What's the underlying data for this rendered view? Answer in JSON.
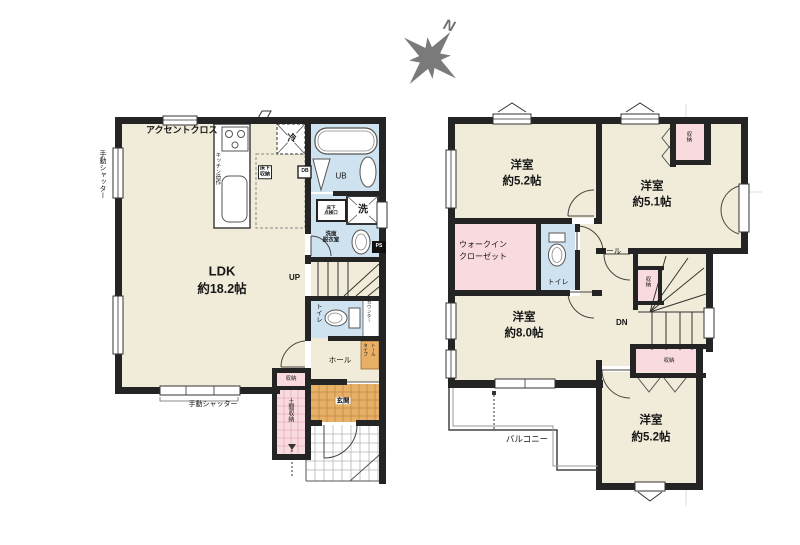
{
  "compass": {
    "north": "N"
  },
  "colors": {
    "wall": "#242424",
    "floor_cream": "#f1ecd9",
    "wet_blue": "#cfe2ef",
    "storage_pink": "#f9dbdf",
    "entrance_orange": "#e7b066",
    "compass_gray": "#7a7a7a"
  },
  "floor1": {
    "shutter_left": "手動シャッター",
    "accent_cross": "アクセントクロス",
    "kitchen": "キッチン造作",
    "fridge": "冷",
    "underfloor_storage": "床下\n収納",
    "db": "DB",
    "unit_bath": "UB",
    "inspection_hatch": "床下\n点検口",
    "laundry": "洗",
    "washroom": "洗面\n脱衣室",
    "pipe_space": "PS",
    "ldk_name": "LDK",
    "ldk_size": "約18.2帖",
    "up": "UP",
    "toilet": "トイレ",
    "counter": "カウンター",
    "hall": "ホール",
    "tall_cabinet": "トール\nタイプ",
    "storage": "収納",
    "entrance": "玄関",
    "doma_storage": "土間収納",
    "shutter_bottom": "手動シャッター"
  },
  "floor2": {
    "room_a_name": "洋室",
    "room_a_size": "約5.2帖",
    "room_b_name": "洋室",
    "room_b_size": "約5.1帖",
    "storage_top": "収納",
    "wic": "ウォークイン\nクローゼット",
    "toilet": "トイレ",
    "hall": "ホール",
    "storage_mid": "収納",
    "down": "DN",
    "storage_low": "収納",
    "room_c_name": "洋室",
    "room_c_size": "約8.0帖",
    "balcony": "バルコニー",
    "room_d_name": "洋室",
    "room_d_size": "約5.2帖"
  }
}
